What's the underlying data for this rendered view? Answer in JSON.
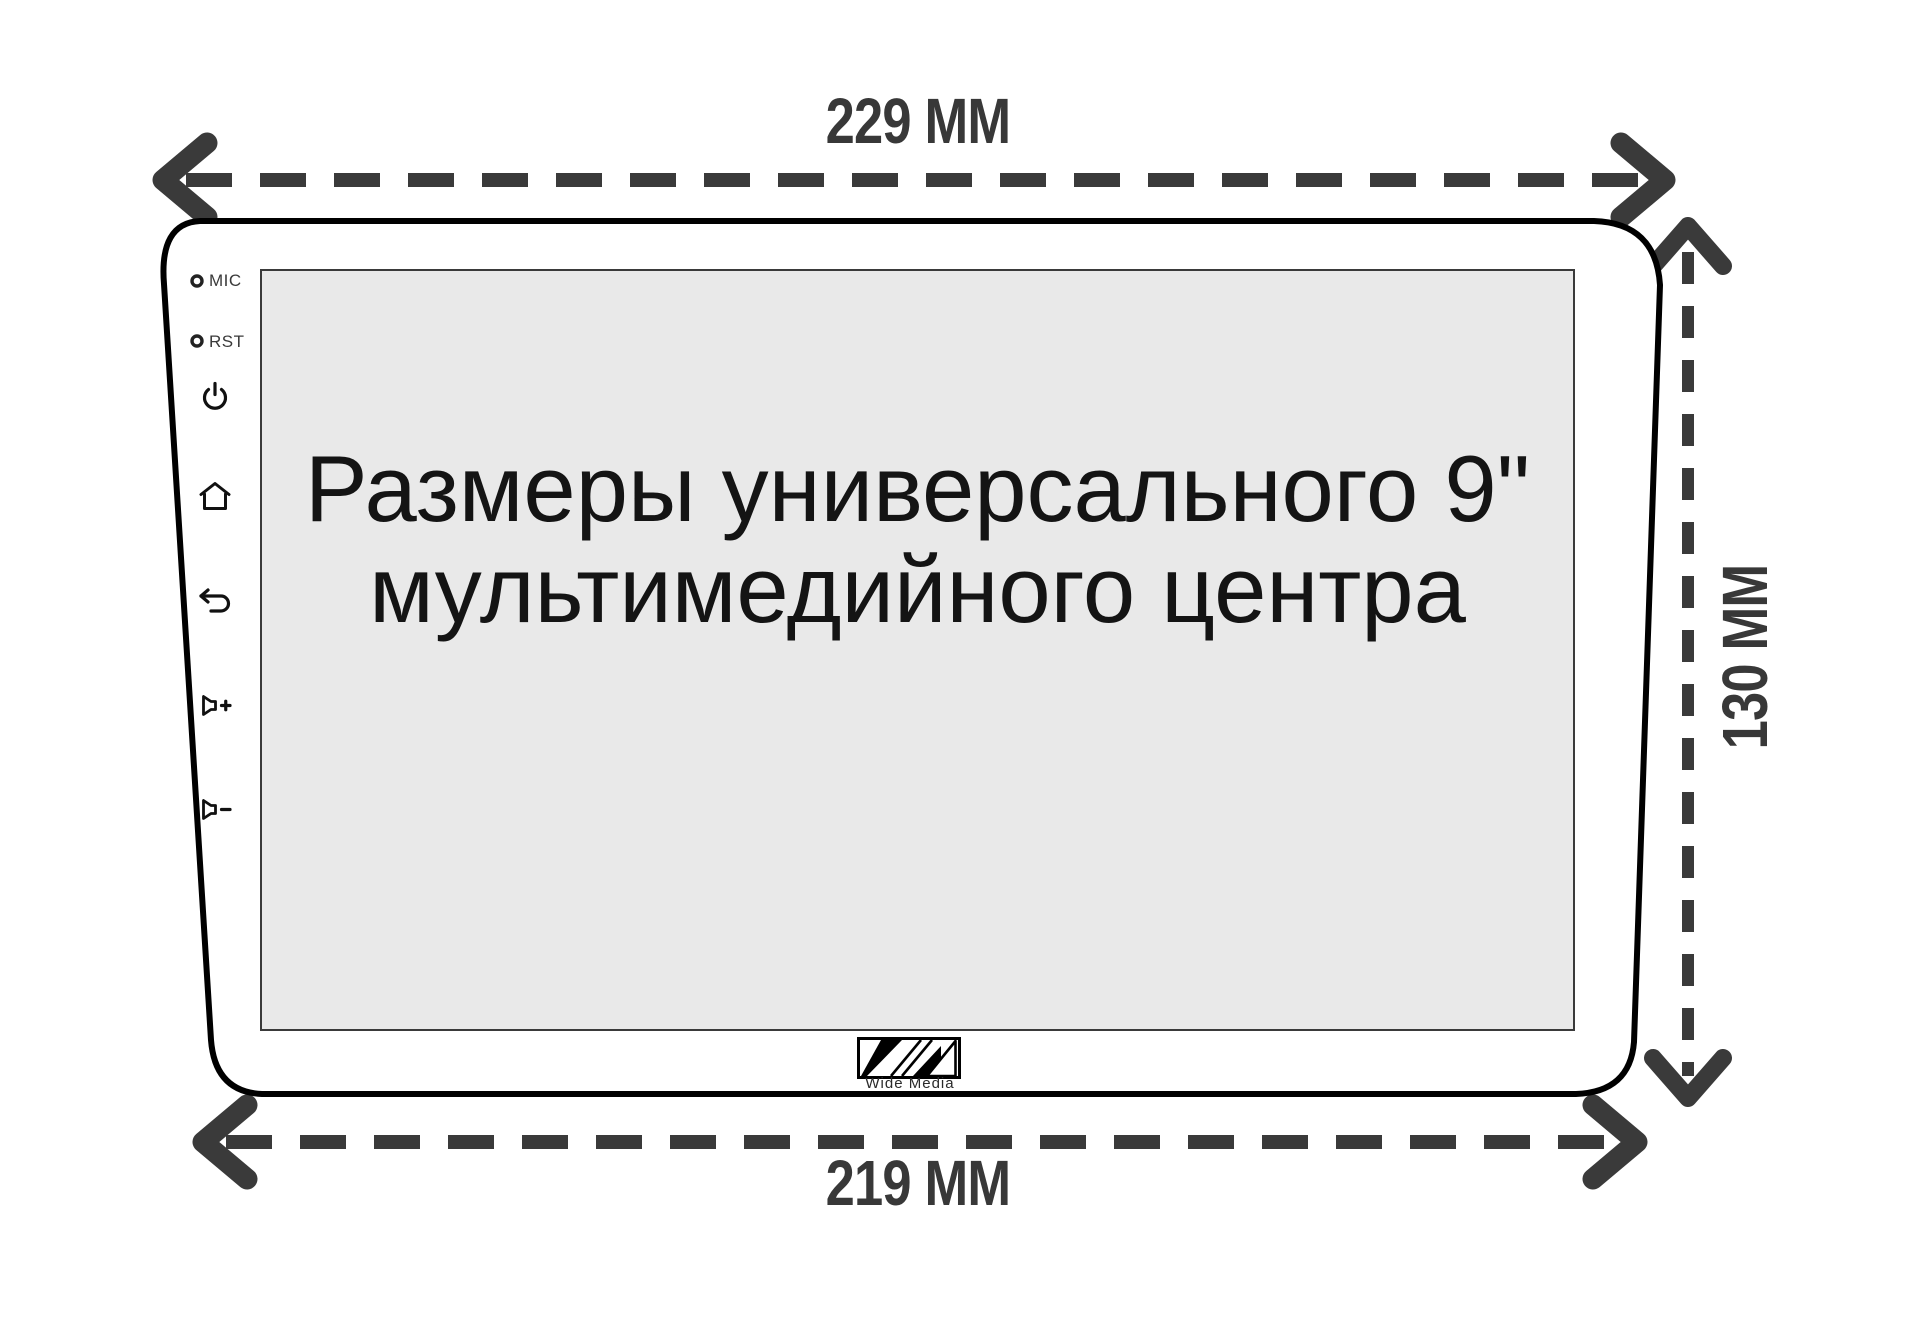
{
  "dimension_labels": {
    "top_width": "229 MM",
    "bottom_width": "219 MM",
    "side_height": "130 MM"
  },
  "screen_caption": {
    "line1": "Размеры универсального 9\"",
    "line2": "мультимедийного центра"
  },
  "bezel_labels": {
    "mic": "MIC",
    "rst": "RST"
  },
  "bezel_icons": [
    {
      "name": "power-icon"
    },
    {
      "name": "home-icon"
    },
    {
      "name": "back-icon"
    },
    {
      "name": "volume-up-icon"
    },
    {
      "name": "volume-down-icon"
    }
  ],
  "logo": {
    "text": "Wide Media"
  },
  "colors": {
    "dimension_accent": "#3a3a3a",
    "outline": "#000000",
    "screen_background": "#e9e9e9",
    "caption_text": "#141414"
  }
}
